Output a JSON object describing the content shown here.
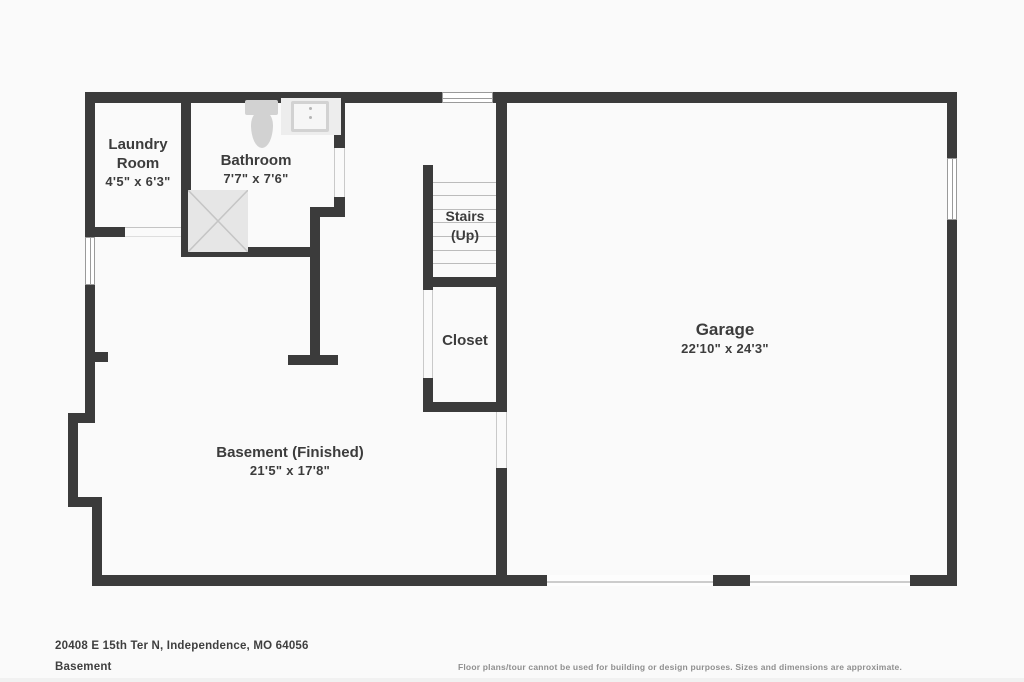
{
  "floor_plan": {
    "rooms": {
      "laundry": {
        "name": "Laundry Room",
        "dims": "4'5\" x 6'3\""
      },
      "bathroom": {
        "name": "Bathroom",
        "dims": "7'7\" x 7'6\""
      },
      "stairs": {
        "name": "Stairs",
        "direction": "(Up)"
      },
      "closet": {
        "name": "Closet"
      },
      "garage": {
        "name": "Garage",
        "dims": "22'10\" x 24'3\""
      },
      "basement": {
        "name": "Basement (Finished)",
        "dims": "21'5\" x 17'8\""
      }
    },
    "fixtures": [
      "toilet",
      "sink",
      "shower"
    ],
    "colors": {
      "wall": "#3b3b3b",
      "label_text": "#3c3c3c",
      "fixture_fill": "#d2d2d2",
      "shower_fill": "#e6e6e6",
      "background": "#fafafa"
    }
  },
  "footer": {
    "address": "20408 E 15th Ter N, Independence, MO 64056",
    "level": "Basement",
    "disclaimer": "Floor plans/tour cannot be used for building or design purposes. Sizes and dimensions are approximate."
  }
}
